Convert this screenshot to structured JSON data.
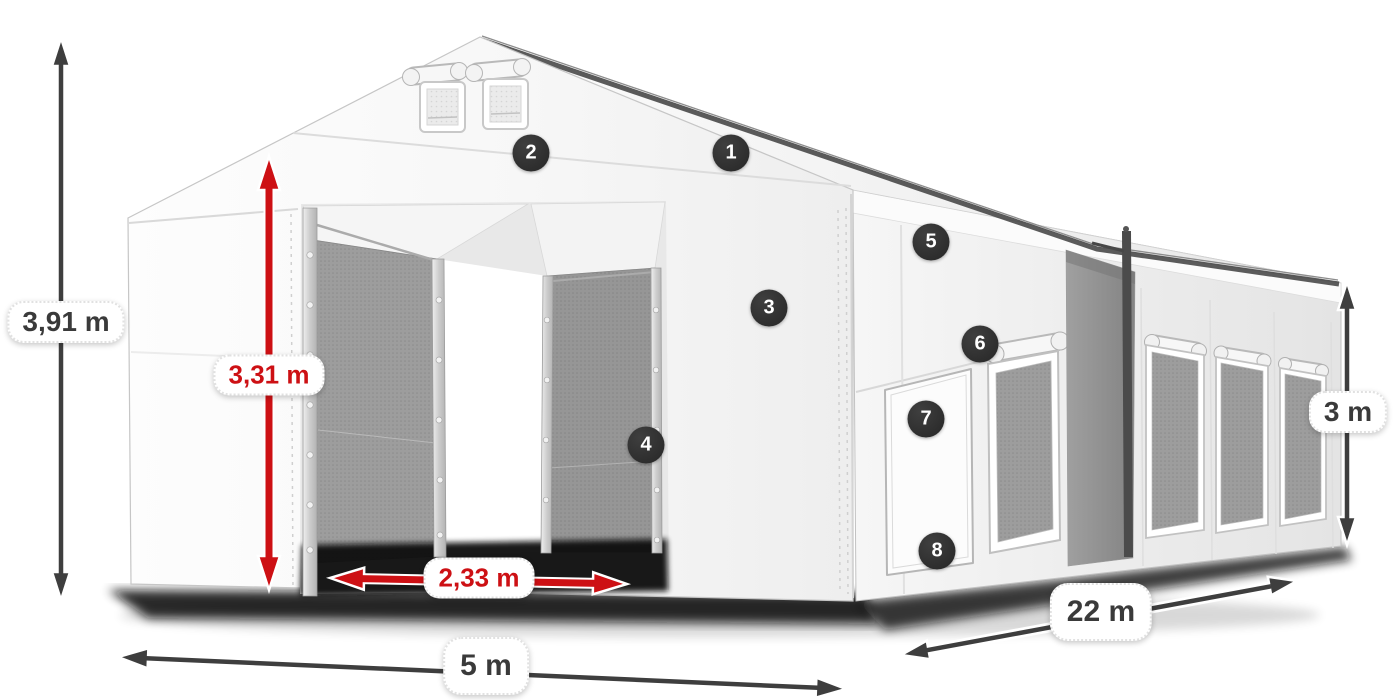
{
  "diagram": {
    "subject": "storage-tent-with-dimensions",
    "units": "m"
  },
  "colors": {
    "accent_red": "#cd1014",
    "arrow_dark": "#3e3e3e",
    "badge_background": "#2c2c2c",
    "label_text_dark": "#3a3a3a",
    "tent_white": "#ffffff",
    "mesh_gray": "#9d9d9d"
  },
  "dimensions": {
    "total_height": {
      "label": "3,91 m"
    },
    "door_height": {
      "label": "3,31 m"
    },
    "door_width": {
      "label": "2,33 m"
    },
    "width": {
      "label": "5 m"
    },
    "length": {
      "label": "22 m"
    },
    "side_height": {
      "label": "3 m"
    }
  },
  "callouts": [
    {
      "number": "1"
    },
    {
      "number": "2"
    },
    {
      "number": "3"
    },
    {
      "number": "4"
    },
    {
      "number": "5"
    },
    {
      "number": "6"
    },
    {
      "number": "7"
    },
    {
      "number": "8"
    }
  ]
}
